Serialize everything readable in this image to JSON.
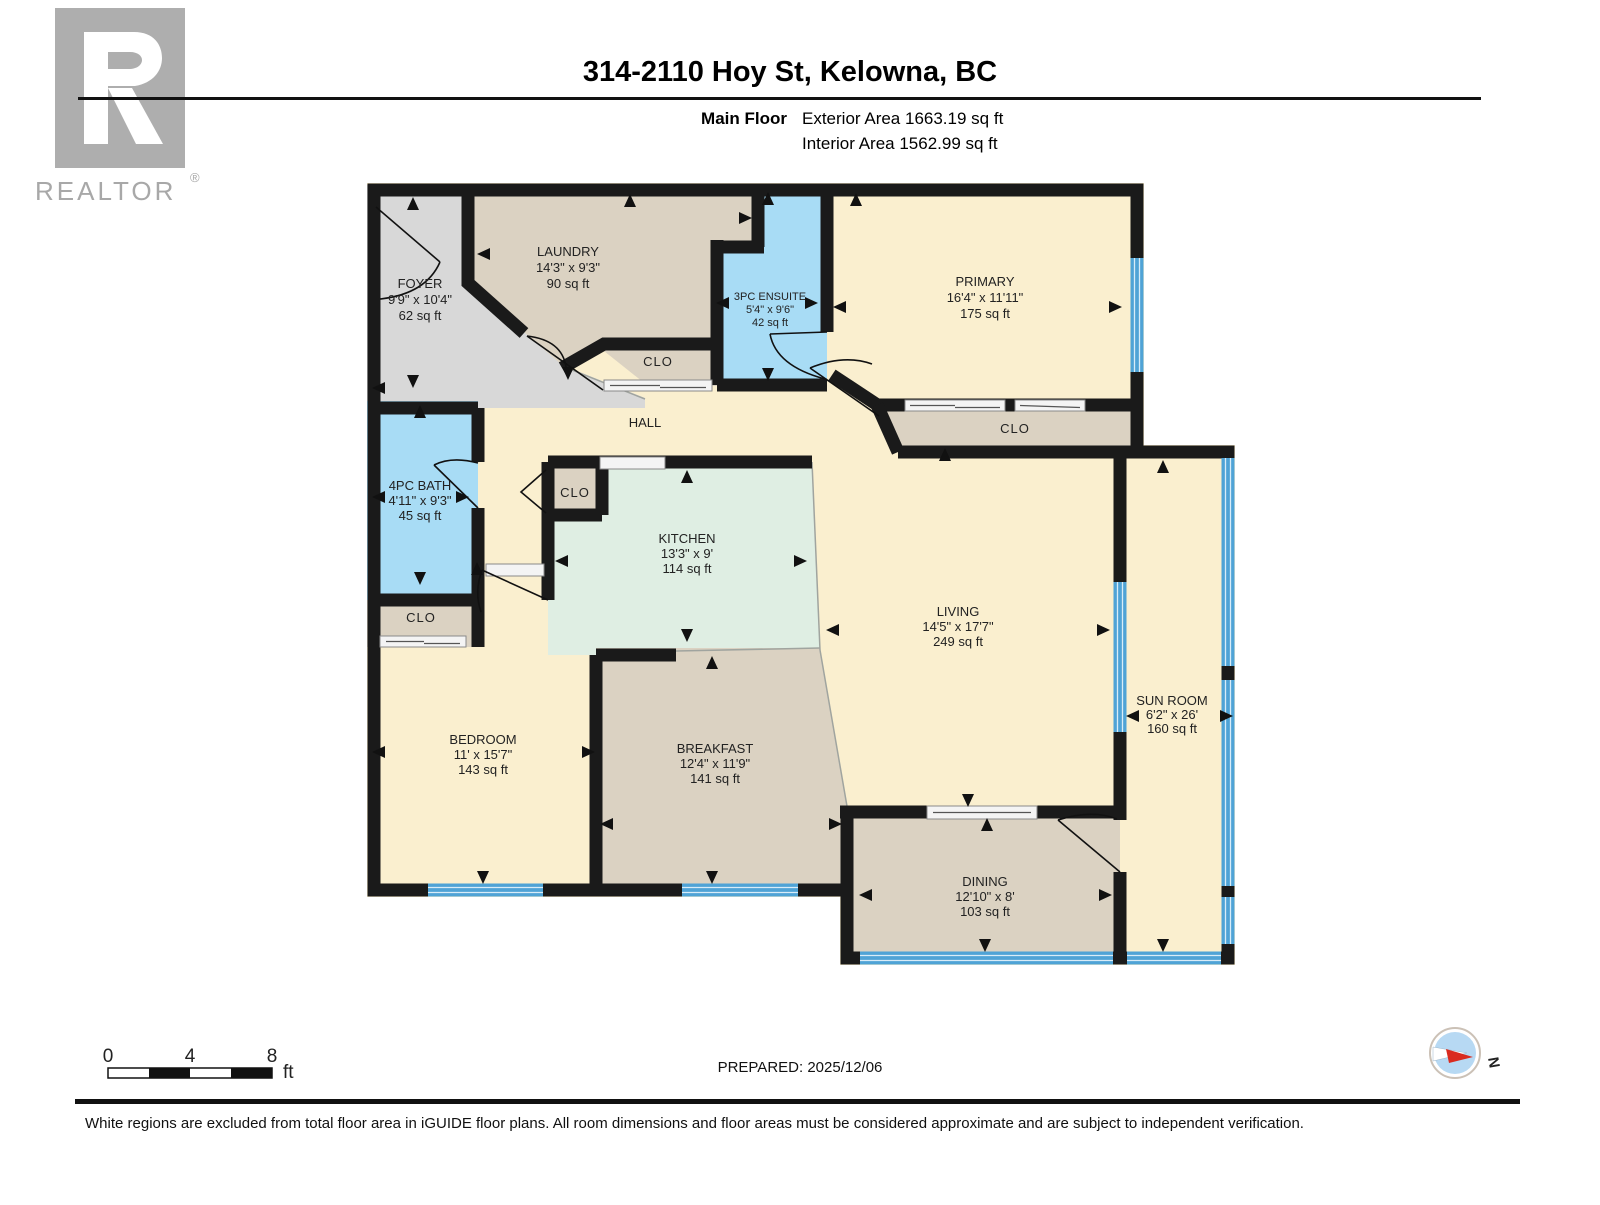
{
  "header": {
    "logo_text": "REALTOR",
    "logo_reg": "®",
    "title": "314-2110 Hoy St, Kelowna, BC",
    "floor_label": "Main Floor",
    "exterior_area": "Exterior Area 1663.19 sq ft",
    "interior_area": "Interior Area 1562.99 sq ft"
  },
  "rooms": {
    "foyer": {
      "name": "FOYER",
      "dims": "9'9\" x 10'4\"",
      "area": "62 sq ft"
    },
    "laundry": {
      "name": "LAUNDRY",
      "dims": "14'3\" x 9'3\"",
      "area": "90 sq ft"
    },
    "ensuite": {
      "name": "3PC ENSUITE",
      "dims": "5'4\" x 9'6\"",
      "area": "42 sq ft"
    },
    "primary": {
      "name": "PRIMARY",
      "dims": "16'4\" x 11'11\"",
      "area": "175 sq ft"
    },
    "hall": {
      "name": "HALL"
    },
    "bath": {
      "name": "4PC BATH",
      "dims": "4'11\" x 9'3\"",
      "area": "45 sq ft"
    },
    "kitchen": {
      "name": "KITCHEN",
      "dims": "13'3\" x 9'",
      "area": "114 sq ft"
    },
    "living": {
      "name": "LIVING",
      "dims": "14'5\" x 17'7\"",
      "area": "249 sq ft"
    },
    "sunroom": {
      "name": "SUN ROOM",
      "dims": "6'2\" x 26'",
      "area": "160 sq ft"
    },
    "bedroom": {
      "name": "BEDROOM",
      "dims": "11' x 15'7\"",
      "area": "143 sq ft"
    },
    "breakfast": {
      "name": "BREAKFAST",
      "dims": "12'4\" x 11'9\"",
      "area": "141 sq ft"
    },
    "dining": {
      "name": "DINING",
      "dims": "12'10\" x 8'",
      "area": "103 sq ft"
    },
    "closet_label": "CLO"
  },
  "footer": {
    "prepared": "PREPARED: 2025/12/06",
    "disclaimer": "White regions are excluded from total floor area in iGUIDE floor plans. All room dimensions and floor areas must be considered approximate and are subject to independent verification.",
    "scale_ticks": [
      "0",
      "4",
      "8"
    ],
    "scale_unit": "ft",
    "compass_north": "N"
  },
  "colors": {
    "wall": "#1a1a1a",
    "cream": "#faefcf",
    "tan": "#dbd2c2",
    "gray": "#d8d8d8",
    "blue_room": "#a8dcf5",
    "mint": "#dfeee3",
    "window": "#4fa3d6"
  }
}
